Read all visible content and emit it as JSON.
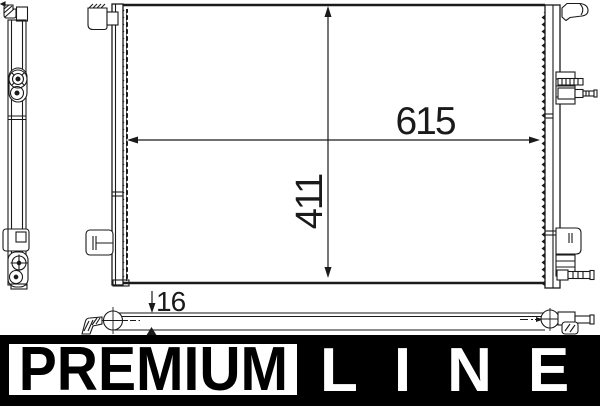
{
  "dimensions": {
    "width": "615",
    "height": "411",
    "depth": "16"
  },
  "logo": {
    "premium": "PREMIUM",
    "line": "LINE"
  },
  "colors": {
    "line_color": "#1a1a1a",
    "background": "#ffffff",
    "logo_bg": "#000000",
    "logo_text_light": "#ffffff",
    "logo_text_dark": "#000000"
  }
}
